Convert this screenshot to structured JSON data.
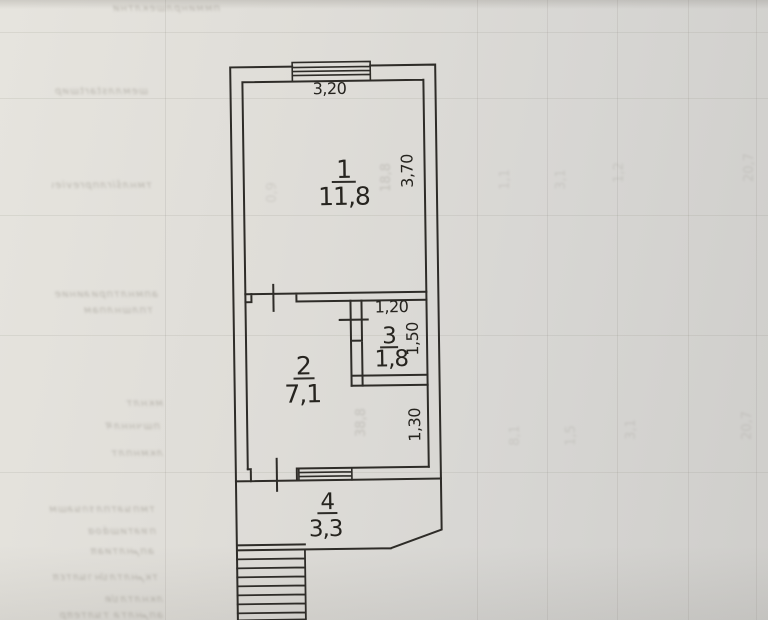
{
  "floorplan": {
    "rooms": [
      {
        "number": "1",
        "area": "11,8"
      },
      {
        "number": "2",
        "area": "7,1"
      },
      {
        "number": "3",
        "area": "1,8"
      },
      {
        "number": "4",
        "area": "3,3"
      }
    ],
    "dimensions": {
      "room1_width": "3,20",
      "room1_depth": "3,70",
      "room3_width": "1,20",
      "room3_depth": "1,50",
      "passage_width": "1,30"
    }
  },
  "bleedthrough": {
    "numbers": [
      "18,8",
      "38,8",
      "0,9",
      "1,1",
      "3,1",
      "1,2",
      "20,7",
      "8,1",
      "1,5",
      "3,1",
      "20,7"
    ],
    "lines": [
      "пмминрлшеклтни",
      "шемллstartшир",
      "тмнлširлпpreviewм",
      "апмнлтприลиние",
      "тплшнлпам",
      "мкнлт",
      "пшчннлम",
      "лкмнплт",
      "тмпนลтплรกนลшм",
      "пหลтишάοα",
      "апمнлтиаπ",
      "ткمнлтлปнานлтεπ",
      "лкнлтлปต",
      "апمнлтล тนлтеπр"
    ]
  },
  "colors": {
    "paper_light": "#e6e4de",
    "paper_dark": "#cfcecb",
    "ink": "#2e2c28"
  }
}
